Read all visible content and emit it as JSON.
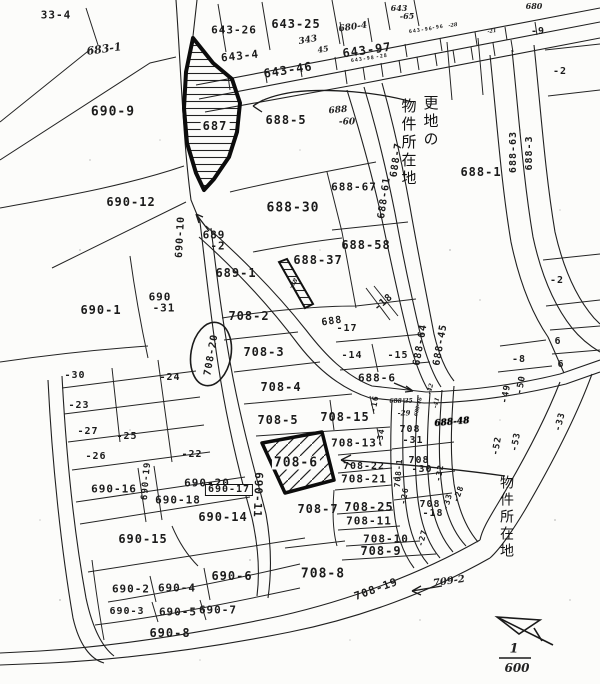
{
  "map": {
    "type": "japanese-cadastral-parcel-map",
    "colors": {
      "ink": "#1b1b1b",
      "paper": "#fcfcfa"
    },
    "scale_text": {
      "numerator": "1",
      "denominator": "600"
    },
    "annotations": {
      "vacant_property_note": "更地の物件所在地",
      "property_note": "物件所在地"
    },
    "vertical_labels": [
      {
        "t": "更地の",
        "x": 431,
        "y": 95,
        "s": 15,
        "n": "annotation-vacant-line1"
      },
      {
        "t": "物件所在地",
        "x": 409,
        "y": 98,
        "s": 15,
        "n": "annotation-vacant-line2"
      },
      {
        "t": "物件所在地",
        "x": 506,
        "y": 475,
        "s": 14,
        "n": "annotation-property-location"
      }
    ],
    "labels": [
      {
        "t": "33-4",
        "x": 56,
        "y": 15,
        "s": 11
      },
      {
        "t": "683-1",
        "x": 104,
        "y": 49,
        "s": 11,
        "f": "h",
        "r": -8
      },
      {
        "t": "690-9",
        "x": 113,
        "y": 112,
        "s": 13
      },
      {
        "t": "690-12",
        "x": 131,
        "y": 202,
        "s": 12
      },
      {
        "t": "690-1",
        "x": 101,
        "y": 310,
        "s": 12
      },
      {
        "t": "690",
        "x": 160,
        "y": 297,
        "s": 11
      },
      {
        "t": "-31",
        "x": 164,
        "y": 308,
        "s": 11
      },
      {
        "t": "689",
        "x": 214,
        "y": 235,
        "s": 11
      },
      {
        "t": "-2",
        "x": 218,
        "y": 246,
        "s": 11
      },
      {
        "t": "690-10",
        "x": 181,
        "y": 237,
        "s": 10,
        "r": -87
      },
      {
        "t": "643-26",
        "x": 234,
        "y": 30,
        "s": 11
      },
      {
        "t": "643-25",
        "x": 296,
        "y": 24,
        "s": 12
      },
      {
        "t": "643-4",
        "x": 240,
        "y": 56,
        "s": 11,
        "r": -6
      },
      {
        "t": "643-46",
        "x": 288,
        "y": 70,
        "s": 12,
        "r": -9
      },
      {
        "t": "343",
        "x": 308,
        "y": 41,
        "s": 9,
        "f": "h",
        "r": -10
      },
      {
        "t": "45",
        "x": 323,
        "y": 49,
        "s": 8,
        "f": "h",
        "r": -10
      },
      {
        "t": "680-4",
        "x": 353,
        "y": 28,
        "s": 9,
        "f": "h",
        "r": -8
      },
      {
        "t": "643",
        "x": 399,
        "y": 8,
        "s": 8,
        "f": "h"
      },
      {
        "t": "-65",
        "x": 407,
        "y": 16,
        "s": 8,
        "f": "h"
      },
      {
        "t": "643-97",
        "x": 367,
        "y": 50,
        "s": 12,
        "r": -8
      },
      {
        "t": "643-96",
        "x": 421,
        "y": 31,
        "s": 5,
        "r": -8
      },
      {
        "t": "-96",
        "x": 438,
        "y": 28,
        "s": 5,
        "r": -8
      },
      {
        "t": "-28",
        "x": 453,
        "y": 26,
        "s": 5,
        "f": "h",
        "r": -8
      },
      {
        "t": "643-98",
        "x": 363,
        "y": 60,
        "s": 5,
        "r": -8
      },
      {
        "t": "-28",
        "x": 382,
        "y": 57,
        "s": 5,
        "r": -8
      },
      {
        "t": "-21",
        "x": 492,
        "y": 32,
        "s": 5,
        "f": "h",
        "r": -8
      },
      {
        "t": "680",
        "x": 534,
        "y": 6,
        "s": 8,
        "f": "h"
      },
      {
        "t": "-9",
        "x": 538,
        "y": 32,
        "s": 10
      },
      {
        "t": "-2",
        "x": 560,
        "y": 72,
        "s": 10
      },
      {
        "t": "688-1",
        "x": 481,
        "y": 172,
        "s": 12
      },
      {
        "t": "688-63",
        "x": 514,
        "y": 152,
        "s": 10,
        "r": -90
      },
      {
        "t": "688-3",
        "x": 530,
        "y": 153,
        "s": 10,
        "r": -90
      },
      {
        "t": "-2",
        "x": 557,
        "y": 281,
        "s": 10
      },
      {
        "t": "6",
        "x": 558,
        "y": 342,
        "s": 10
      },
      {
        "t": "6",
        "x": 561,
        "y": 365,
        "s": 10
      },
      {
        "t": "-8",
        "x": 519,
        "y": 360,
        "s": 10
      },
      {
        "t": "-49",
        "x": 507,
        "y": 394,
        "s": 9,
        "r": -80
      },
      {
        "t": "-50",
        "x": 522,
        "y": 385,
        "s": 9,
        "r": -80
      },
      {
        "t": "-33",
        "x": 561,
        "y": 422,
        "s": 9,
        "r": -75
      },
      {
        "t": "-52",
        "x": 498,
        "y": 446,
        "s": 9,
        "r": -80
      },
      {
        "t": "-53",
        "x": 517,
        "y": 442,
        "s": 9,
        "r": -80
      },
      {
        "t": "687",
        "x": 215,
        "y": 126,
        "s": 12,
        "bg": true
      },
      {
        "t": "688-5",
        "x": 286,
        "y": 120,
        "s": 12
      },
      {
        "t": "688",
        "x": 338,
        "y": 111,
        "s": 9,
        "f": "h",
        "r": -5
      },
      {
        "t": "-60",
        "x": 347,
        "y": 123,
        "s": 9,
        "f": "h"
      },
      {
        "t": "688-7",
        "x": 397,
        "y": 160,
        "s": 10,
        "r": -82
      },
      {
        "t": "688-61",
        "x": 385,
        "y": 198,
        "s": 10,
        "r": -82
      },
      {
        "t": "688-67",
        "x": 354,
        "y": 187,
        "s": 11
      },
      {
        "t": "688-30",
        "x": 293,
        "y": 208,
        "s": 13
      },
      {
        "t": "689-1",
        "x": 236,
        "y": 273,
        "s": 12
      },
      {
        "t": "688-37",
        "x": 318,
        "y": 260,
        "s": 12
      },
      {
        "t": "-38",
        "x": 294,
        "y": 284,
        "s": 6,
        "f": "h",
        "r": -55
      },
      {
        "t": "688-58",
        "x": 366,
        "y": 245,
        "s": 12
      },
      {
        "t": "688",
        "x": 332,
        "y": 322,
        "s": 10,
        "r": -8
      },
      {
        "t": "-17",
        "x": 347,
        "y": 329,
        "s": 10
      },
      {
        "t": "-14",
        "x": 352,
        "y": 356,
        "s": 10
      },
      {
        "t": "-15",
        "x": 398,
        "y": 356,
        "s": 10
      },
      {
        "t": "-18",
        "x": 384,
        "y": 303,
        "s": 10,
        "r": -40
      },
      {
        "t": "688-6",
        "x": 377,
        "y": 378,
        "s": 11
      },
      {
        "t": "708-2",
        "x": 249,
        "y": 316,
        "s": 12
      },
      {
        "t": "708-20",
        "x": 212,
        "y": 355,
        "s": 10,
        "r": -80
      },
      {
        "t": "708-3",
        "x": 264,
        "y": 352,
        "s": 12
      },
      {
        "t": "708-4",
        "x": 281,
        "y": 387,
        "s": 12
      },
      {
        "t": "708-5",
        "x": 278,
        "y": 420,
        "s": 12
      },
      {
        "t": "708-15",
        "x": 345,
        "y": 417,
        "s": 12
      },
      {
        "t": "688-64",
        "x": 421,
        "y": 345,
        "s": 10,
        "r": -80
      },
      {
        "t": "688-45",
        "x": 441,
        "y": 345,
        "s": 10,
        "r": -80
      },
      {
        "t": "688-35",
        "x": 401,
        "y": 402,
        "s": 6,
        "f": "h"
      },
      {
        "t": "-29",
        "x": 404,
        "y": 413,
        "s": 7,
        "f": "h"
      },
      {
        "t": "688-46",
        "x": 419,
        "y": 407,
        "s": 5,
        "f": "h",
        "r": -75
      },
      {
        "t": "-42",
        "x": 431,
        "y": 389,
        "s": 6,
        "f": "h",
        "r": -75
      },
      {
        "t": "-41",
        "x": 437,
        "y": 403,
        "s": 6,
        "f": "h",
        "r": -75
      },
      {
        "t": "688-48",
        "x": 452,
        "y": 423,
        "s": 9,
        "f": "b",
        "r": -5
      },
      {
        "t": "708",
        "x": 410,
        "y": 430,
        "s": 10
      },
      {
        "t": "-31",
        "x": 413,
        "y": 441,
        "s": 10
      },
      {
        "t": "708",
        "x": 419,
        "y": 461,
        "s": 10
      },
      {
        "t": "-30",
        "x": 422,
        "y": 470,
        "s": 10
      },
      {
        "t": "708-13",
        "x": 354,
        "y": 443,
        "s": 11
      },
      {
        "t": "708-22",
        "x": 364,
        "y": 467,
        "s": 10
      },
      {
        "t": "708-21",
        "x": 364,
        "y": 479,
        "s": 11
      },
      {
        "t": "708-6",
        "x": 296,
        "y": 463,
        "s": 13,
        "bg": true
      },
      {
        "t": "-30",
        "x": 75,
        "y": 376,
        "s": 10
      },
      {
        "t": "-24",
        "x": 170,
        "y": 378,
        "s": 10
      },
      {
        "t": "-23",
        "x": 79,
        "y": 406,
        "s": 10
      },
      {
        "t": "-27",
        "x": 88,
        "y": 432,
        "s": 10
      },
      {
        "t": "-25",
        "x": 127,
        "y": 437,
        "s": 10
      },
      {
        "t": "-26",
        "x": 96,
        "y": 457,
        "s": 10
      },
      {
        "t": "-22",
        "x": 192,
        "y": 455,
        "s": 10
      },
      {
        "t": "690-16",
        "x": 114,
        "y": 489,
        "s": 11
      },
      {
        "t": "690-19",
        "x": 147,
        "y": 481,
        "s": 9,
        "r": -85
      },
      {
        "t": "690-20",
        "x": 207,
        "y": 483,
        "s": 11
      },
      {
        "t": "690-18",
        "x": 178,
        "y": 500,
        "s": 11
      },
      {
        "t": "690-17",
        "x": 229,
        "y": 490,
        "s": 10,
        "box": true
      },
      {
        "t": "690-11",
        "x": 258,
        "y": 495,
        "s": 11,
        "r": 92
      },
      {
        "t": "690-15",
        "x": 143,
        "y": 539,
        "s": 12
      },
      {
        "t": "690-14",
        "x": 223,
        "y": 517,
        "s": 12
      },
      {
        "t": "708-7",
        "x": 318,
        "y": 509,
        "s": 12
      },
      {
        "t": "708-25",
        "x": 369,
        "y": 507,
        "s": 12
      },
      {
        "t": "708-11",
        "x": 369,
        "y": 521,
        "s": 11
      },
      {
        "t": "708-10",
        "x": 386,
        "y": 539,
        "s": 11
      },
      {
        "t": "708-9",
        "x": 381,
        "y": 551,
        "s": 12
      },
      {
        "t": "708-8",
        "x": 323,
        "y": 574,
        "s": 13
      },
      {
        "t": "708",
        "x": 430,
        "y": 505,
        "s": 10
      },
      {
        "t": "-18",
        "x": 433,
        "y": 514,
        "s": 10
      },
      {
        "t": "-16",
        "x": 375,
        "y": 404,
        "s": 8,
        "r": -80
      },
      {
        "t": "-34",
        "x": 381,
        "y": 437,
        "s": 8,
        "r": -80
      },
      {
        "t": "-32",
        "x": 440,
        "y": 473,
        "s": 8,
        "r": -80
      },
      {
        "t": "-33",
        "x": 448,
        "y": 502,
        "s": 8,
        "r": -75
      },
      {
        "t": "-28",
        "x": 459,
        "y": 494,
        "s": 8,
        "r": -70
      },
      {
        "t": "-27",
        "x": 423,
        "y": 538,
        "s": 8,
        "r": -75
      },
      {
        "t": "-26",
        "x": 405,
        "y": 496,
        "s": 8,
        "r": -80
      },
      {
        "t": "708-1",
        "x": 399,
        "y": 473,
        "s": 8,
        "r": -85
      },
      {
        "t": "708-19",
        "x": 376,
        "y": 589,
        "s": 11,
        "r": -20
      },
      {
        "t": "709-2",
        "x": 449,
        "y": 582,
        "s": 10,
        "f": "h",
        "r": -8
      },
      {
        "t": "690-2",
        "x": 131,
        "y": 589,
        "s": 11
      },
      {
        "t": "690-4",
        "x": 177,
        "y": 588,
        "s": 11
      },
      {
        "t": "690-6",
        "x": 232,
        "y": 576,
        "s": 12
      },
      {
        "t": "690-3",
        "x": 127,
        "y": 612,
        "s": 10
      },
      {
        "t": "690-5",
        "x": 178,
        "y": 612,
        "s": 11
      },
      {
        "t": "690-7",
        "x": 218,
        "y": 610,
        "s": 11
      },
      {
        "t": "690-8",
        "x": 170,
        "y": 633,
        "s": 12
      },
      {
        "t": "1",
        "x": 514,
        "y": 649,
        "s": 13,
        "f": "h",
        "n": "scale-numerator"
      },
      {
        "t": "600",
        "x": 517,
        "y": 668,
        "s": 12,
        "f": "h",
        "n": "scale-denominator"
      }
    ]
  }
}
